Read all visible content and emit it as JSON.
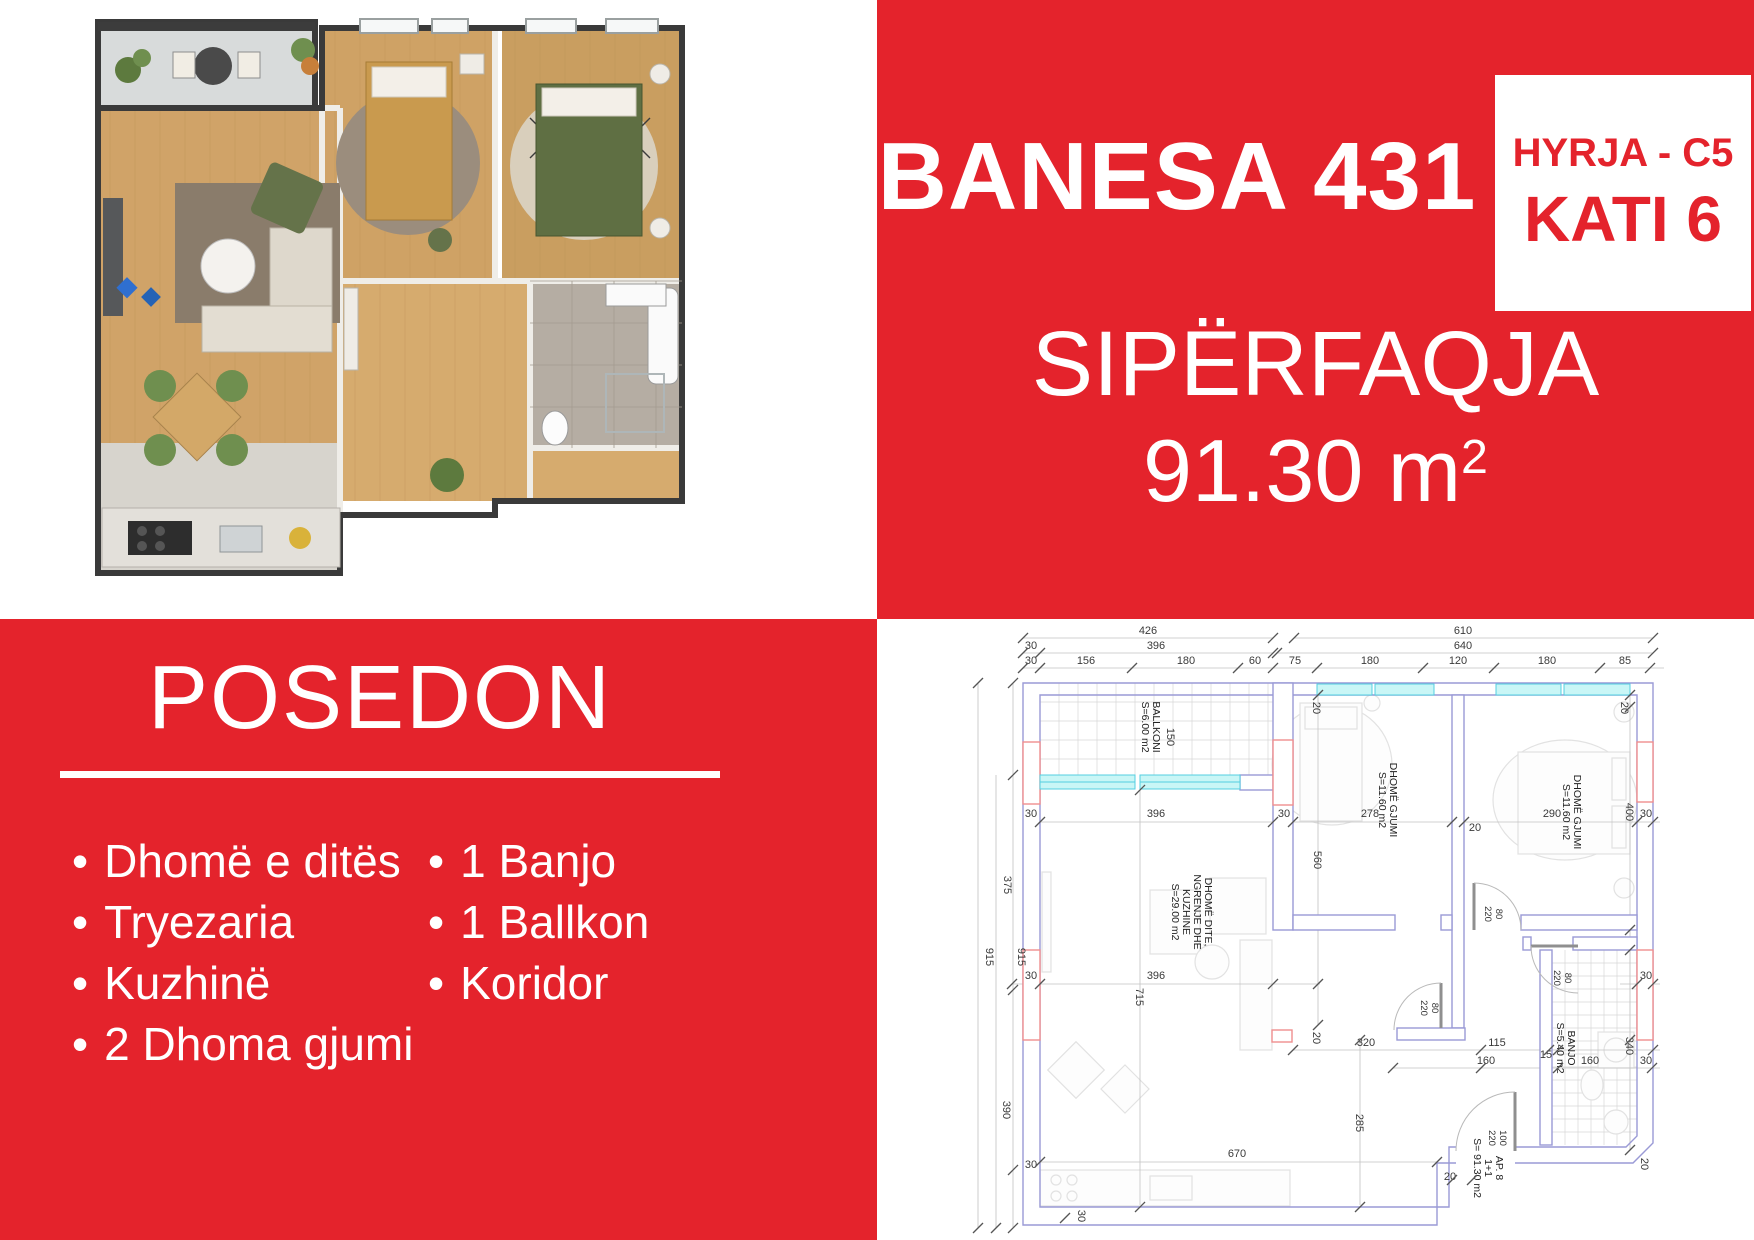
{
  "colors": {
    "accent_red": "#e4232c",
    "wall_blue": "#9a9ad6",
    "window_cyan": "#54cfe0",
    "opening_red": "#ef8f8f"
  },
  "top_right": {
    "title": "BANESA 431",
    "entrance_label": "HYRJA - C5",
    "floor_label": "KATI 6",
    "area_heading": "SIPËRFAQJA",
    "area_value": "91.30 m",
    "area_sup": "2"
  },
  "bottom_left": {
    "heading": "POSEDON",
    "bullet": "•",
    "features_left": [
      "Dhomë e ditës",
      "Tryezaria",
      "Kuzhinë",
      "2 Dhoma gjumi"
    ],
    "features_right": [
      "1 Banjo",
      "1 Ballkon",
      "Koridor"
    ]
  },
  "floor_plan": {
    "labels": [
      {
        "t": "426",
        "x": 1148,
        "y": 634
      },
      {
        "t": "610",
        "x": 1463,
        "y": 634
      },
      {
        "t": "30",
        "x": 1031,
        "y": 649
      },
      {
        "t": "396",
        "x": 1156,
        "y": 649
      },
      {
        "t": "640",
        "x": 1463,
        "y": 649
      },
      {
        "t": "30",
        "x": 1031,
        "y": 664
      },
      {
        "t": "156",
        "x": 1086,
        "y": 664
      },
      {
        "t": "180",
        "x": 1186,
        "y": 664
      },
      {
        "t": "60",
        "x": 1255,
        "y": 664
      },
      {
        "t": "75",
        "x": 1295,
        "y": 664
      },
      {
        "t": "180",
        "x": 1370,
        "y": 664
      },
      {
        "t": "120",
        "x": 1458,
        "y": 664
      },
      {
        "t": "180",
        "x": 1547,
        "y": 664
      },
      {
        "t": "85",
        "x": 1625,
        "y": 664
      },
      {
        "t": "375",
        "x": 1004,
        "y": 885,
        "r": 90
      },
      {
        "t": "915",
        "x": 986,
        "y": 957,
        "r": 90
      },
      {
        "t": "915",
        "x": 1018,
        "y": 957,
        "r": 90
      },
      {
        "t": "390",
        "x": 1003,
        "y": 1110,
        "r": 90
      },
      {
        "t": "30",
        "x": 1078,
        "y": 1216,
        "r": 90
      },
      {
        "t": "30",
        "x": 1031,
        "y": 817
      },
      {
        "t": "30",
        "x": 1031,
        "y": 979
      },
      {
        "t": "30",
        "x": 1031,
        "y": 1168
      },
      {
        "t": "396",
        "x": 1156,
        "y": 817
      },
      {
        "t": "30",
        "x": 1284,
        "y": 817
      },
      {
        "t": "278",
        "x": 1370,
        "y": 817
      },
      {
        "t": "20",
        "x": 1475,
        "y": 831
      },
      {
        "t": "290",
        "x": 1552,
        "y": 817
      },
      {
        "t": "30",
        "x": 1646,
        "y": 817
      },
      {
        "t": "396",
        "x": 1156,
        "y": 979
      },
      {
        "t": "30",
        "x": 1646,
        "y": 979
      },
      {
        "t": "715",
        "x": 1136,
        "y": 997,
        "r": 90
      },
      {
        "t": "560",
        "x": 1314,
        "y": 860,
        "r": 90
      },
      {
        "t": "285",
        "x": 1356,
        "y": 1123,
        "r": 90
      },
      {
        "t": "20",
        "x": 1313,
        "y": 708,
        "r": 90
      },
      {
        "t": "20",
        "x": 1621,
        "y": 708,
        "r": 90
      },
      {
        "t": "400",
        "x": 1626,
        "y": 812,
        "r": 90
      },
      {
        "t": "340",
        "x": 1626,
        "y": 1046,
        "r": 90
      },
      {
        "t": "30",
        "x": 1646,
        "y": 1064
      },
      {
        "t": "20",
        "x": 1313,
        "y": 1038,
        "r": 90
      },
      {
        "t": "320",
        "x": 1366,
        "y": 1046
      },
      {
        "t": "115",
        "x": 1497,
        "y": 1046
      },
      {
        "t": "15",
        "x": 1546,
        "y": 1058
      },
      {
        "t": "160",
        "x": 1486,
        "y": 1064
      },
      {
        "t": "160",
        "x": 1590,
        "y": 1064
      },
      {
        "t": "670",
        "x": 1237,
        "y": 1157
      },
      {
        "t": "20",
        "x": 1450,
        "y": 1180
      },
      {
        "t": "20",
        "x": 1641,
        "y": 1164,
        "r": 90
      },
      {
        "t": "150",
        "x": 1167,
        "y": 737,
        "r": 90
      },
      {
        "t": "80",
        "x": 1496,
        "y": 914,
        "r": 90,
        "c": "door"
      },
      {
        "t": "220",
        "x": 1485,
        "y": 914,
        "r": 90,
        "c": "door"
      },
      {
        "t": "80",
        "x": 1432,
        "y": 1008,
        "r": 90,
        "c": "door"
      },
      {
        "t": "220",
        "x": 1421,
        "y": 1008,
        "r": 90,
        "c": "door"
      },
      {
        "t": "80",
        "x": 1565,
        "y": 978,
        "r": 90,
        "c": "door"
      },
      {
        "t": "220",
        "x": 1554,
        "y": 978,
        "r": 90,
        "c": "door"
      },
      {
        "t": "100",
        "x": 1500,
        "y": 1138,
        "r": 90,
        "c": "door"
      },
      {
        "t": "220",
        "x": 1489,
        "y": 1138,
        "r": 90,
        "c": "door"
      },
      {
        "t": "BALLKONI",
        "x": 1153,
        "y": 727,
        "r": 90,
        "c": "room"
      },
      {
        "t": "S=6.00 m2",
        "x": 1142,
        "y": 727,
        "r": 90,
        "c": "room"
      },
      {
        "t": "DHOMË GJUMI",
        "x": 1390,
        "y": 800,
        "r": 90,
        "c": "room"
      },
      {
        "t": "S=11.60 m2",
        "x": 1379,
        "y": 800,
        "r": 90,
        "c": "room"
      },
      {
        "t": "DHOMË GJUMI",
        "x": 1574,
        "y": 812,
        "r": 90,
        "c": "room"
      },
      {
        "t": "S=11.60 m2",
        "x": 1563,
        "y": 812,
        "r": 90,
        "c": "room"
      },
      {
        "t": "DHOMË DITE,",
        "x": 1205,
        "y": 912,
        "r": 90,
        "c": "room"
      },
      {
        "t": "NGRENJE DHE",
        "x": 1194,
        "y": 912,
        "r": 90,
        "c": "room"
      },
      {
        "t": "KUZHINE",
        "x": 1183,
        "y": 912,
        "r": 90,
        "c": "room"
      },
      {
        "t": "S=29.00 m2",
        "x": 1172,
        "y": 912,
        "r": 90,
        "c": "room"
      },
      {
        "t": "BANJO",
        "x": 1568,
        "y": 1048,
        "r": 90,
        "c": "room"
      },
      {
        "t": "S=5.40 m2",
        "x": 1557,
        "y": 1048,
        "r": 90,
        "c": "room"
      },
      {
        "t": "AP. 8",
        "x": 1496,
        "y": 1168,
        "r": 90,
        "c": "room"
      },
      {
        "t": "1+1",
        "x": 1485,
        "y": 1168,
        "r": 90,
        "c": "room"
      },
      {
        "t": "S= 91.30 m2",
        "x": 1474,
        "y": 1168,
        "r": 90,
        "c": "room"
      }
    ]
  }
}
